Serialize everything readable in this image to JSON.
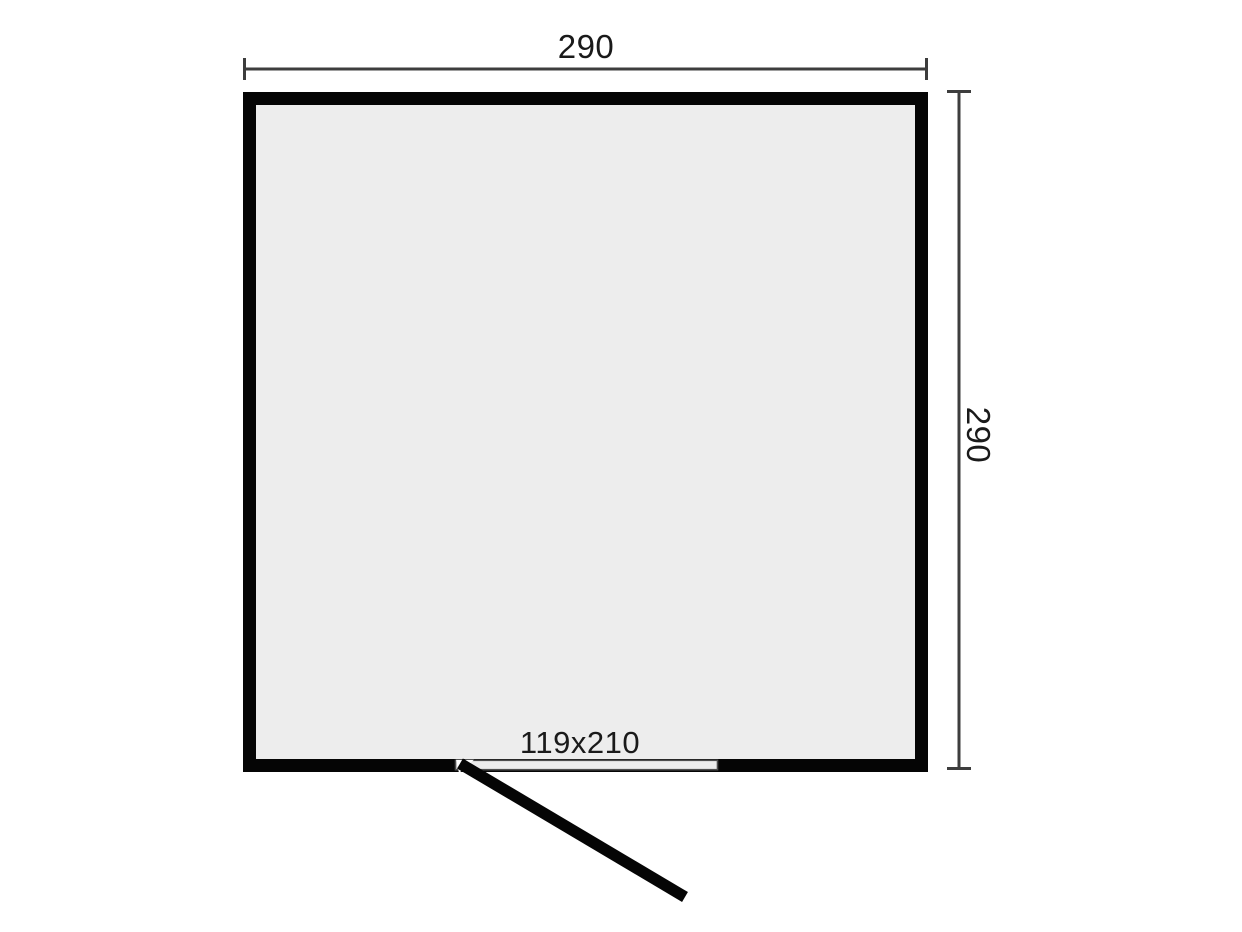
{
  "diagram": {
    "type": "floor-plan",
    "width_dimension": {
      "label": "290",
      "value": 290
    },
    "height_dimension": {
      "label": "290",
      "value": 290
    },
    "door": {
      "size_label": "119x210",
      "width": 119,
      "height": 210
    },
    "colors": {
      "background": "#ffffff",
      "wall": "#050505",
      "interior": "#ededed",
      "door_opening_fill": "#ececec",
      "door_opening_stroke": "#4d4d4d",
      "dimension_line": "#3d3d3d",
      "label_text": "#1a1a1a"
    }
  }
}
